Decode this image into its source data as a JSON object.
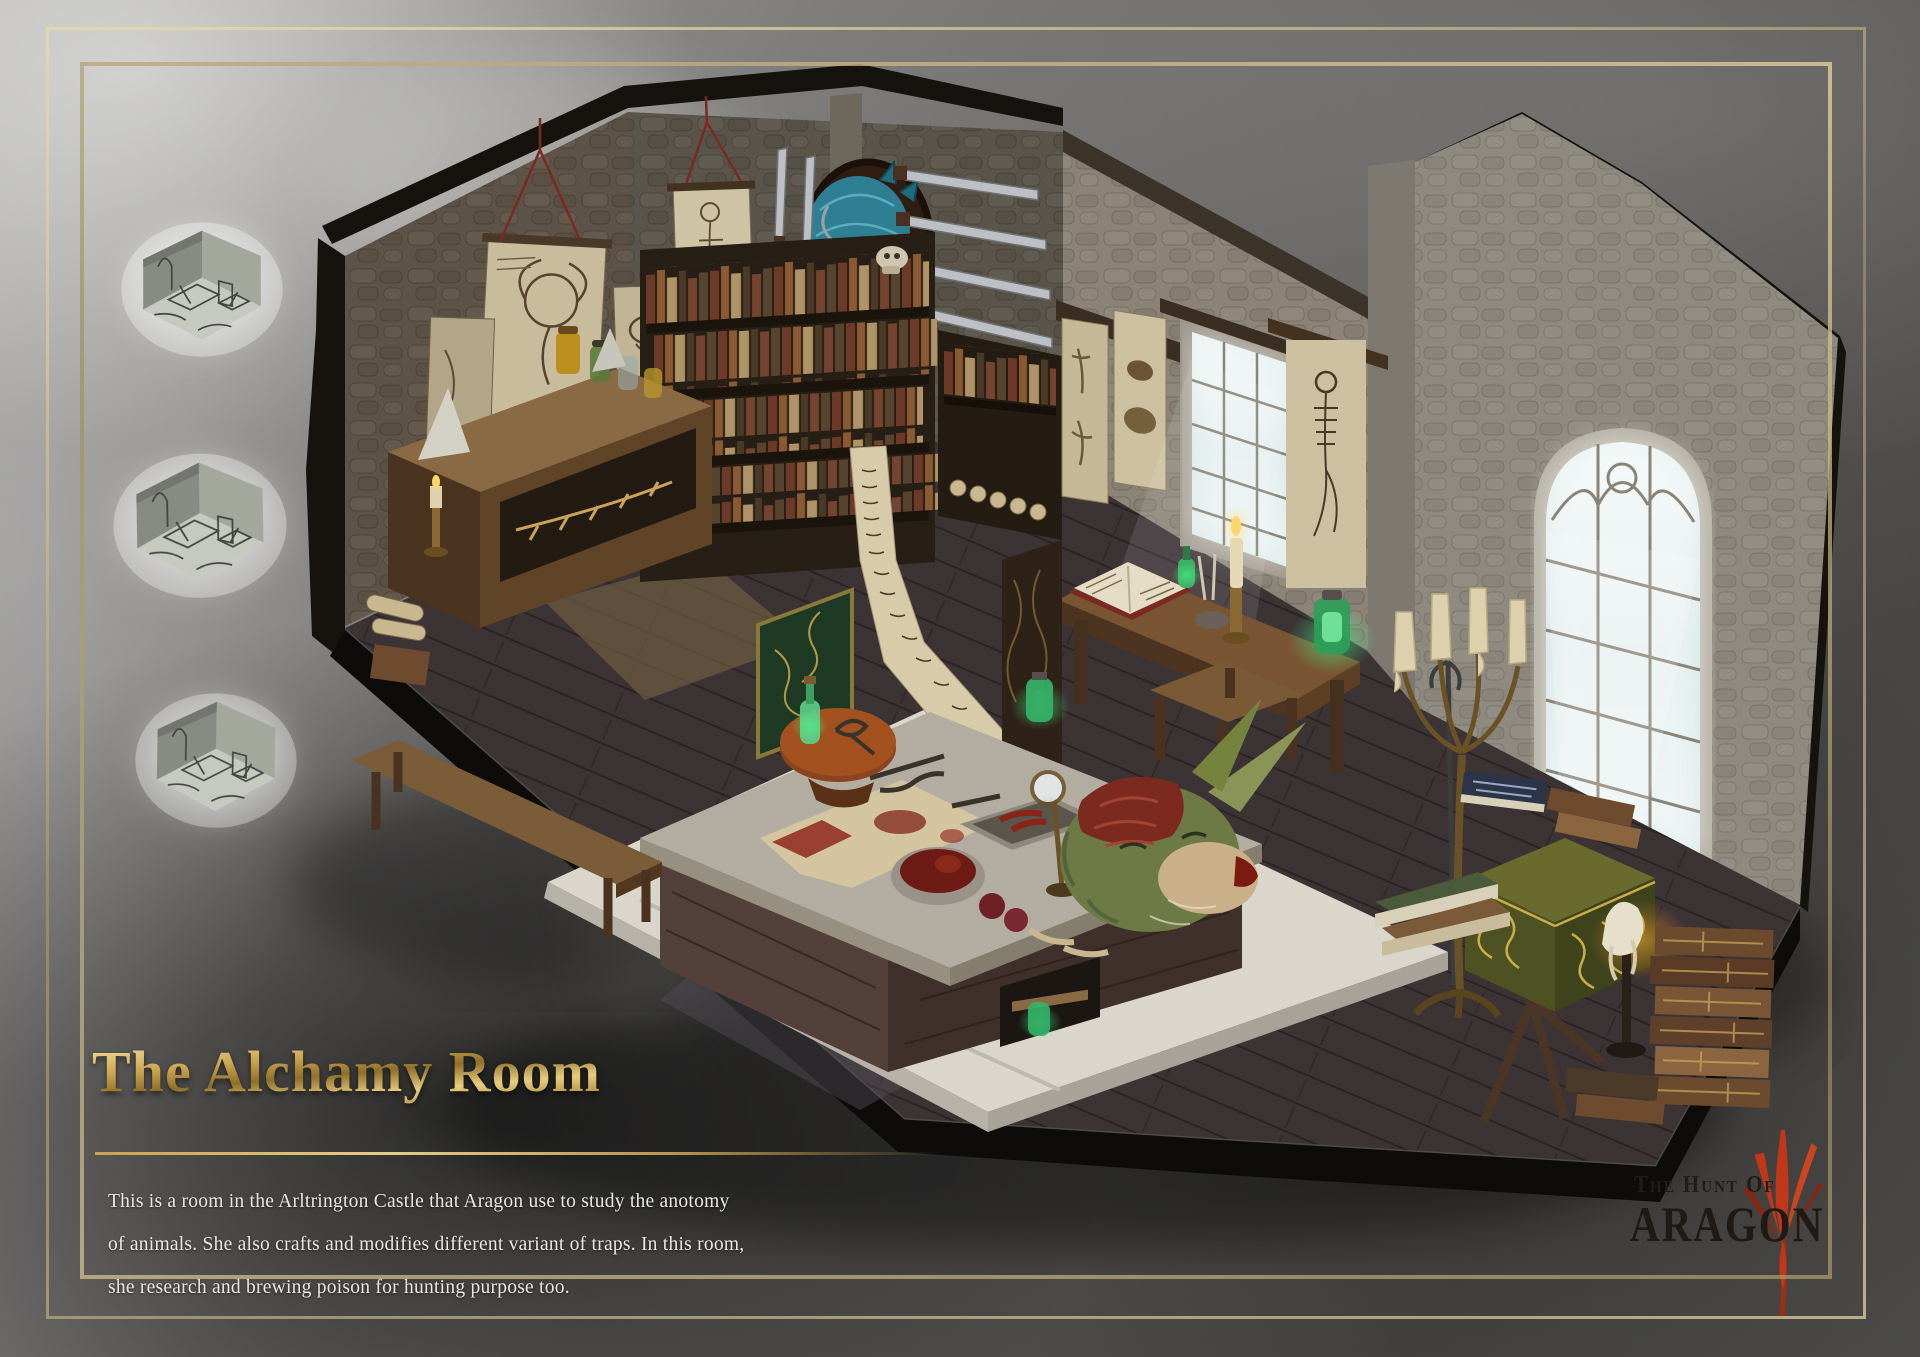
{
  "artwork": {
    "title": "The Alchamy Room",
    "description_lines": [
      "This is a room in the Arltrington Castle that Aragon use to study the anotomy",
      "of animals. She also crafts and modifies different variant of traps. In this room,",
      "she research and brewing poison for hunting purpose too."
    ],
    "logo": {
      "top": "The Hunt Of",
      "bottom": "ARAGON"
    }
  },
  "illustration_elements": [
    "isometric-alchemy-room",
    "stone-walls",
    "monster-head-trophy",
    "mounted-knives",
    "anatomy-posters",
    "bookshelf",
    "potion-jars-shelf",
    "window-desk-with-open-book",
    "hanging-script-scroll",
    "skeleton-scroll",
    "arched-window",
    "standing-candelabra",
    "dissection-table-with-creature-head",
    "blood-bowl",
    "magnifier-stand",
    "green-ornate-chest",
    "book-stacks",
    "reading-lectern",
    "concept-sketch-thumbnails"
  ],
  "colors": {
    "title_gold": "#d9b95c",
    "frame_gold": "#c6b483",
    "background_gray": "#6f6e6c",
    "text_white": "#eae8e2",
    "logo_dark": "#1f1a13",
    "logo_flame_red": "#c2371a",
    "window_glow": "#d7e5e6",
    "potion_green": "#3fae66",
    "creature_teal": "#2e7f93",
    "chest_green_gold": "#6a6a2e"
  }
}
